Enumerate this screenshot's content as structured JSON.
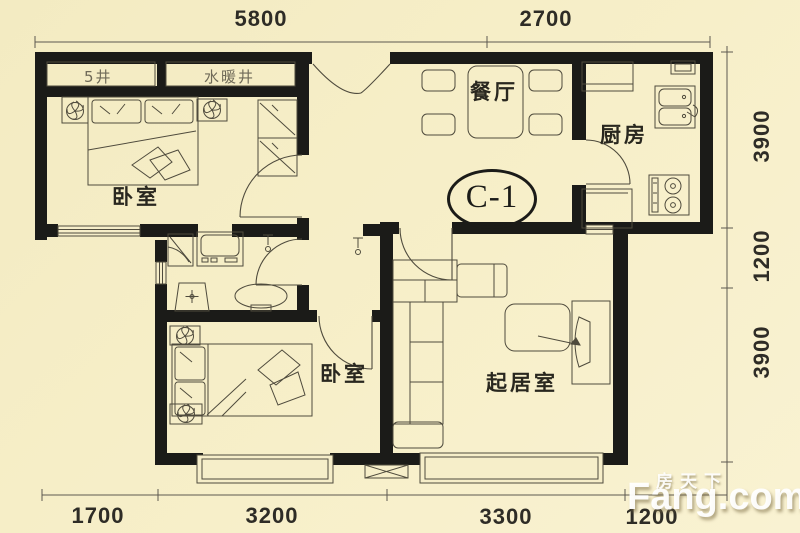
{
  "plan": {
    "unit_label": "C-1",
    "rooms": {
      "bedroom1": "卧室",
      "dining": "餐厅",
      "kitchen": "厨房",
      "bedroom2": "卧室",
      "living": "起居室"
    },
    "shafts": {
      "shaft1": "5井",
      "shaft2": "水暖井"
    },
    "dimensions": {
      "top": [
        "5800",
        "2700"
      ],
      "right": [
        "3900",
        "1200",
        "3900"
      ],
      "bottom": [
        "1700",
        "3200",
        "3300",
        "1200"
      ]
    },
    "watermark": {
      "cn": "房天下",
      "en": "Fang.com"
    },
    "colors": {
      "background": "#f6eec9",
      "wall": "#1b1b18",
      "line": "#4f4b3d",
      "watermark": "#ffffff"
    }
  }
}
